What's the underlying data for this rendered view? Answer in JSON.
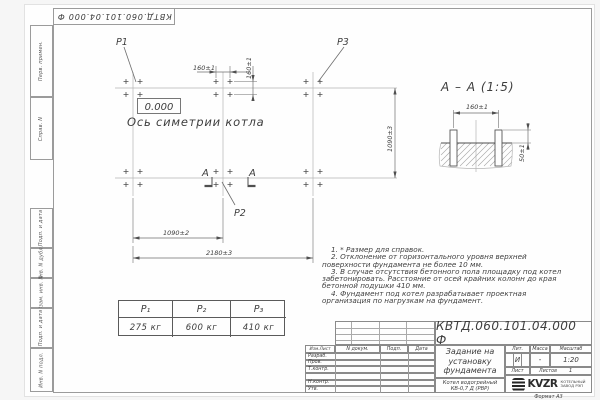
{
  "sheet": {
    "doc_number": "КВТД.060.101.04.000  Ф",
    "format_label": "Формат А3"
  },
  "side_strip": {
    "cells": [
      "Перв. примен.",
      "Справ. N",
      "Подп. и дата",
      "Инв. N дубл.",
      "Взам. инв. N",
      "Подп. и дата",
      "Инв. N подл."
    ]
  },
  "plan": {
    "p1": "P1",
    "p2": "P2",
    "p3": "P3",
    "elevation": "0.000",
    "axis_label": "Ось симетрии котла",
    "section_letter": "А",
    "dim_bolt_horizontal": "160±1",
    "dim_bolt_vertical": "160±1",
    "dim_half_span": "1090±2",
    "dim_full_span": "2180±3",
    "dim_row_span": "1090±3"
  },
  "section_view": {
    "title": "А – А (1:5)",
    "dim_bolt_spacing": "160±1",
    "dim_protrusion": "50±1"
  },
  "notes": [
    "1. * Размер для справок.",
    "2. Отклонение от горизонтального уровня верхней поверхности фундамента не более 10 мм.",
    "3. В случае отсутствия бетонного пола площадку под котел забетонировать. Расстояние от осей крайних колонн до края бетонной подушки 410 мм.",
    "4. Фундамент под котел разрабатывает проектная организация по нагрузкам на фундамент."
  ],
  "load_table": {
    "headers": [
      "P₁",
      "P₂",
      "P₃"
    ],
    "values": [
      "275 кг",
      "600 кг",
      "410 кг"
    ]
  },
  "title_block": {
    "doc_number": "КВТД.060.101.04.000  Ф",
    "title_lines": [
      "Задание на",
      "установку",
      "фундамента"
    ],
    "product_lines": [
      "Котел водогрейный",
      "КВ-0,7 Д  (РВР)"
    ],
    "header_cells": [
      "Изм.Лист",
      "N докум.",
      "Подп.",
      "Дата"
    ],
    "row_labels": [
      "Разраб.",
      "Пров.",
      "Т.контр.",
      "",
      "Н.контр.",
      "Утв."
    ],
    "lit_label": "Лит.",
    "lit_value": "И",
    "mass_label": "Масса",
    "mass_value": "-",
    "scale_label": "Масштаб",
    "scale_value": "1:20",
    "sheet_label": "Лист",
    "sheets_label": "Листов",
    "sheets_value": "1",
    "logo_text": "KVZR",
    "logo_sub_lines": [
      "КОТЕЛЬНЫЙ",
      "ЗАВОД РЭП"
    ]
  },
  "colors": {
    "line_dark": "#4f4f4f",
    "frame_gray": "#9b9b9b",
    "text": "#3d3d3d"
  }
}
